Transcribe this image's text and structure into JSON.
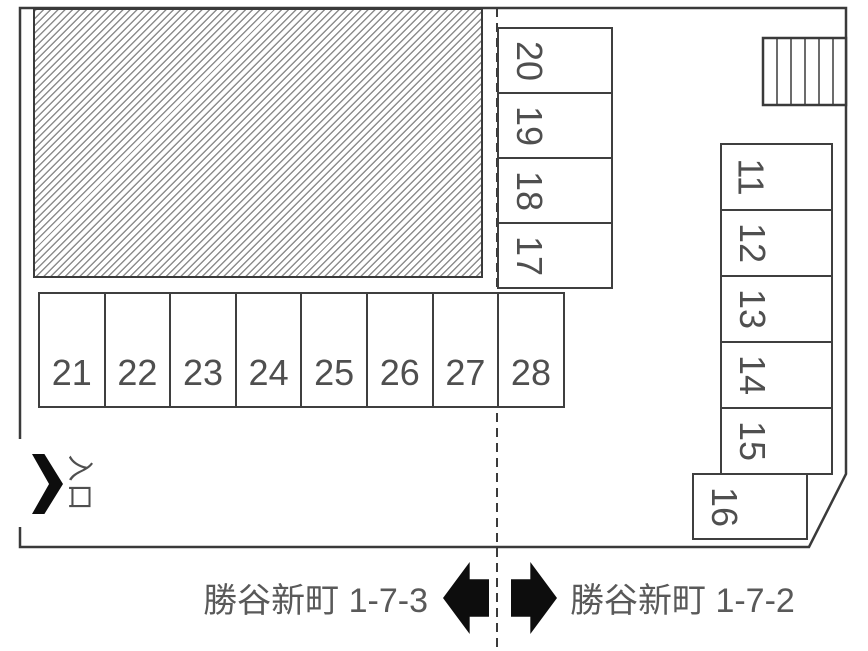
{
  "spaces": {
    "middle_column": [
      "20",
      "19",
      "18",
      "17"
    ],
    "bottom_row": [
      "21",
      "22",
      "23",
      "24",
      "25",
      "26",
      "27",
      "28"
    ],
    "right_column": [
      "11",
      "12",
      "13",
      "14",
      "15"
    ],
    "offset_space": "16"
  },
  "entrance": {
    "label": "入口"
  },
  "streets": {
    "left": "勝谷新町 1-7-3",
    "right": "勝谷新町 1-7-2"
  },
  "colors": {
    "line": "#3a3a3a",
    "grid": "#3f3f3f",
    "num": "#4f4f4f",
    "text": "#595959",
    "arrow": "#0d0d0d",
    "hatch": "#8d8d8d"
  }
}
